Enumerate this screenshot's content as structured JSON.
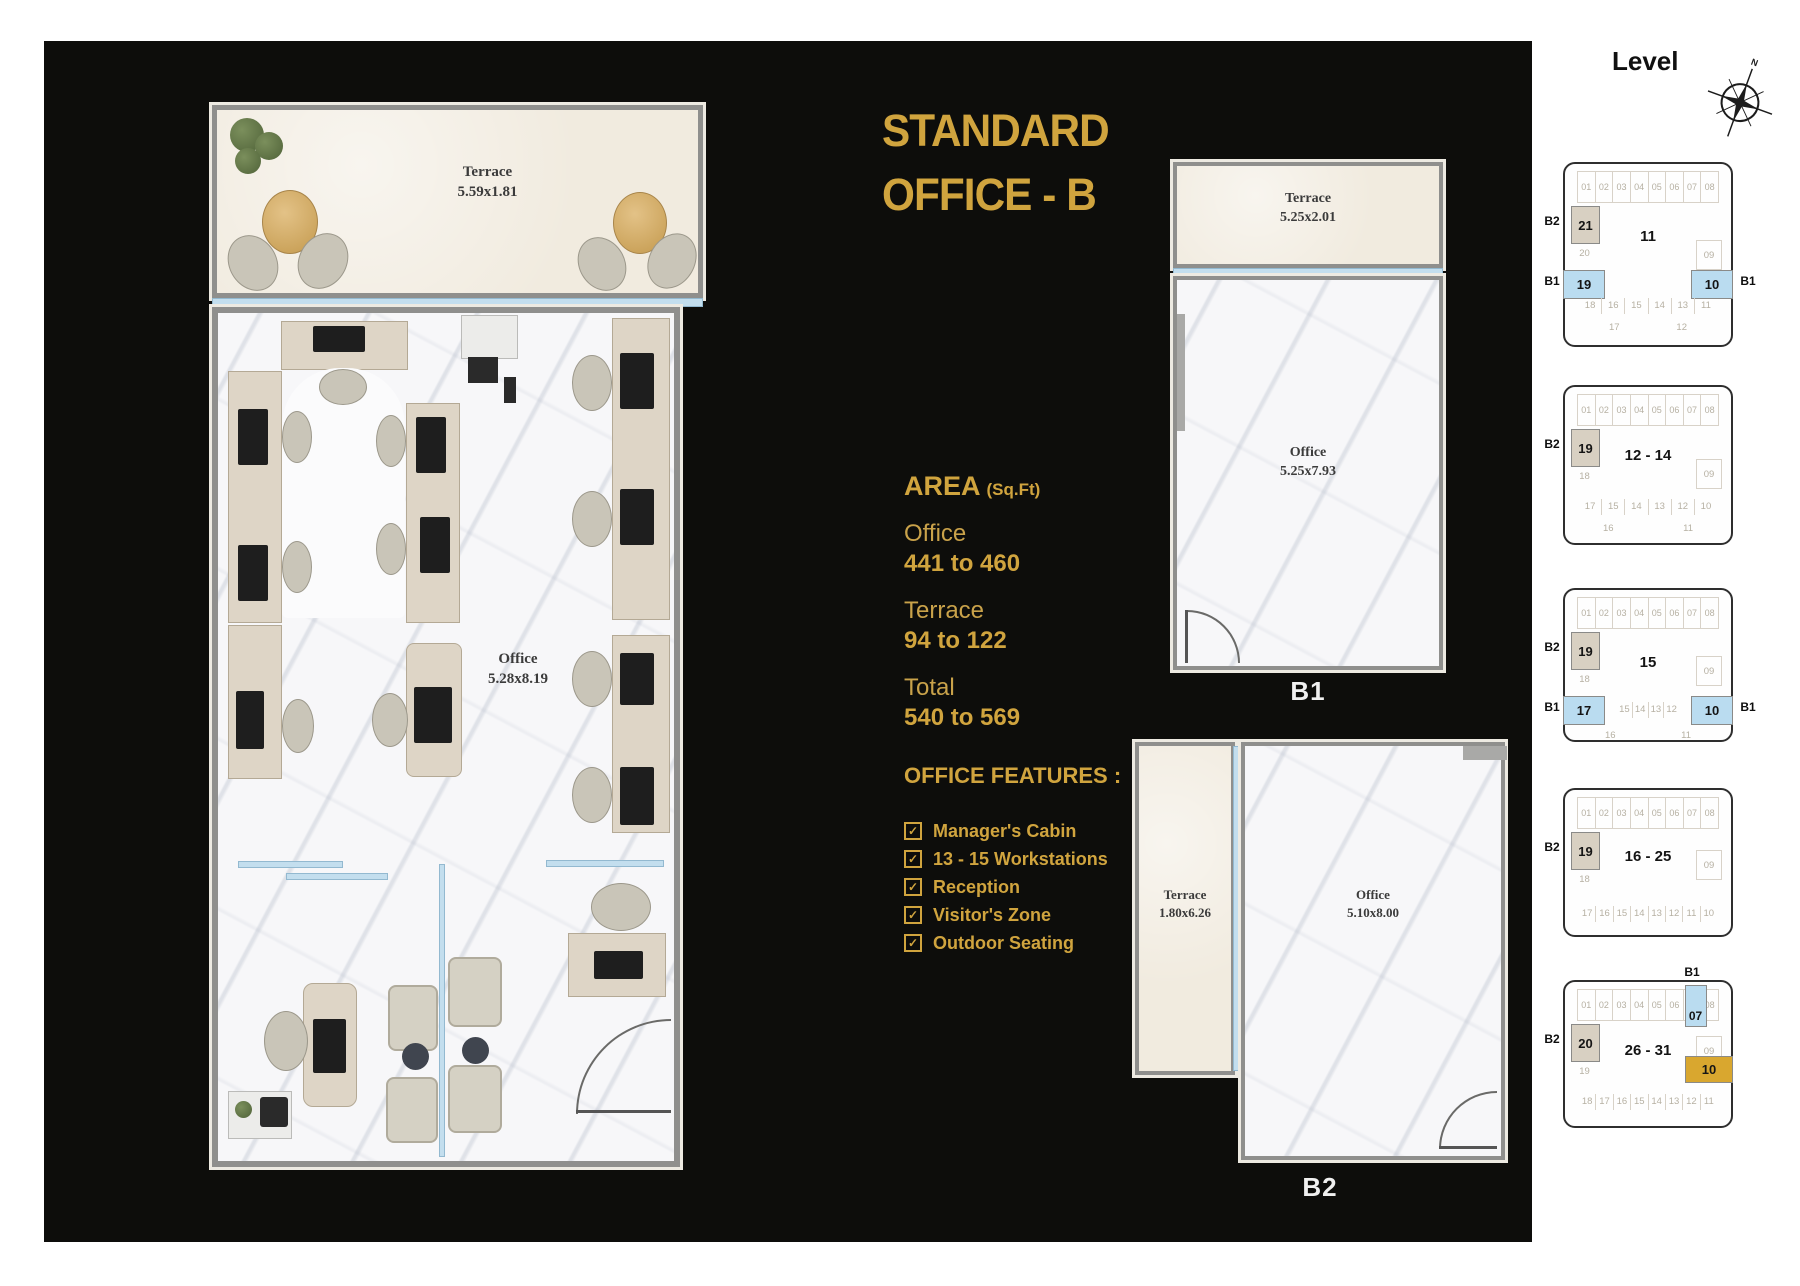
{
  "title": {
    "line1": "STANDARD",
    "line2": "OFFICE - B"
  },
  "area": {
    "heading": "AREA",
    "unit": "(Sq.Ft)",
    "rows": [
      {
        "label": "Office",
        "value": "441 to 460"
      },
      {
        "label": "Terrace",
        "value": "94 to 122"
      },
      {
        "label": "Total",
        "value": "540 to 569"
      }
    ]
  },
  "features": {
    "heading": "OFFICE FEATURES :",
    "items": [
      "Manager's Cabin",
      "13 - 15 Workstations",
      "Reception",
      "Visitor's Zone",
      "Outdoor Seating"
    ]
  },
  "main_plan": {
    "terrace_label": "Terrace",
    "terrace_dims": "5.59x1.81",
    "office_label": "Office",
    "office_dims": "5.28x8.19"
  },
  "plan_b1": {
    "caption": "B1",
    "terrace_label": "Terrace",
    "terrace_dims": "5.25x2.01",
    "office_label": "Office",
    "office_dims": "5.25x7.93"
  },
  "plan_b2": {
    "caption": "B2",
    "terrace_label": "Terrace",
    "terrace_dims": "1.80x6.26",
    "office_label": "Office",
    "office_dims": "5.10x8.00"
  },
  "levels": {
    "heading": "Level",
    "compass_north": "N",
    "diagrams": [
      {
        "name": "level-11",
        "center": "11",
        "b2_tag": "B2",
        "b2_unit": "21",
        "b2_under": "20",
        "top_units": [
          "01",
          "02",
          "03",
          "04",
          "05",
          "06",
          "07",
          "08"
        ],
        "right_unit": "09",
        "b1_left_tag": "B1",
        "b1_left_unit": "19",
        "b1_right_tag": "B1",
        "b1_right_unit": "10",
        "bottom_units": [
          "18",
          "16",
          "15",
          "14",
          "13",
          "11"
        ],
        "bottom_units_2": [
          "17",
          "12"
        ]
      },
      {
        "name": "levels-12-14",
        "center": "12 - 14",
        "b2_tag": "B2",
        "b2_unit": "19",
        "b2_under": "18",
        "top_units": [
          "01",
          "02",
          "03",
          "04",
          "05",
          "06",
          "07",
          "08"
        ],
        "right_unit": "09",
        "bottom_units": [
          "17",
          "15",
          "14",
          "13",
          "12",
          "10"
        ],
        "bottom_units_2": [
          "16",
          "11"
        ]
      },
      {
        "name": "level-15",
        "center": "15",
        "b2_tag": "B2",
        "b2_unit": "19",
        "b2_under": "18",
        "top_units": [
          "01",
          "02",
          "03",
          "04",
          "05",
          "06",
          "07",
          "08"
        ],
        "right_unit": "09",
        "b1_left_tag": "B1",
        "b1_left_unit": "17",
        "b1_right_tag": "B1",
        "b1_right_unit": "10",
        "bottom_units": [
          "15",
          "14",
          "13",
          "12"
        ],
        "bottom_units_2": [
          "16",
          "11"
        ]
      },
      {
        "name": "levels-16-25",
        "center": "16 - 25",
        "b2_tag": "B2",
        "b2_unit": "19",
        "b2_under": "18",
        "top_units": [
          "01",
          "02",
          "03",
          "04",
          "05",
          "06",
          "07",
          "08"
        ],
        "right_unit": "09",
        "bottom_units": [
          "17",
          "16",
          "15",
          "14",
          "13",
          "12",
          "11",
          "10"
        ]
      },
      {
        "name": "levels-26-31",
        "center": "26 - 31",
        "b2_tag": "B2",
        "b2_unit": "20",
        "b2_under": "19",
        "top_units": [
          "01",
          "02",
          "03",
          "04",
          "05",
          "06",
          "07",
          "08"
        ],
        "right_unit": "09",
        "top_highlight": {
          "index": 6,
          "tag": "B1"
        },
        "gold_unit": "10",
        "bottom_units": [
          "18",
          "17",
          "16",
          "15",
          "14",
          "13",
          "12",
          "11"
        ]
      }
    ]
  },
  "colors": {
    "accent_gold": "#d0a43e",
    "highlight_blue": "#badcf0",
    "highlight_tan": "#d8d0c2",
    "highlight_gold_unit": "#d9a72f",
    "panel_background": "#0d0d0b"
  }
}
